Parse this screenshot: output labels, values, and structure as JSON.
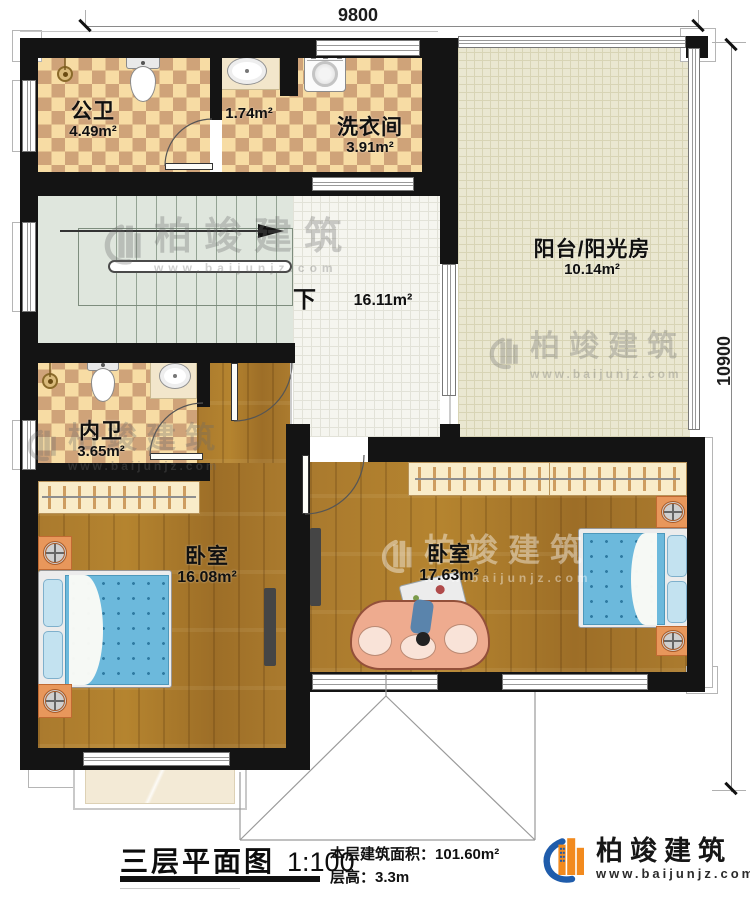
{
  "dims": {
    "top": "9800",
    "right": "10900"
  },
  "rooms": {
    "gongwei": {
      "name": "公卫",
      "area": "4.49m²"
    },
    "vestibule": {
      "area": "1.74m²"
    },
    "laundry": {
      "name": "洗衣间",
      "area": "3.91m²"
    },
    "sunroom": {
      "name": "阳台/阳光房",
      "area": "10.14m²"
    },
    "hall": {
      "stairs_label": "下",
      "area": "16.11m²"
    },
    "neiwei": {
      "name": "内卫",
      "area": "3.65m²"
    },
    "bedroom1": {
      "name": "卧室",
      "area": "16.08m²"
    },
    "bedroom2": {
      "name": "卧室",
      "area": "17.63m²"
    }
  },
  "footer": {
    "title": "三层平面图",
    "scale": "1:100",
    "area_label": "本层建筑面积：",
    "area_value": "101.60m²",
    "height_label": "层高：",
    "height_value": "3.3m"
  },
  "brand": {
    "name": "柏竣建筑",
    "url": "www.baijunjz.com"
  },
  "watermark": {
    "name": "柏竣建筑",
    "url": "www.baijunjz.com"
  },
  "colors": {
    "wall": "#141414",
    "checker_light": "#f7dca4",
    "checker_dark": "#cfa379",
    "wood": "#aa7a2e",
    "wood_dark": "#9d6e27",
    "tile_hall": "#f5f5ef",
    "sunroom": "#eae7d1",
    "stairs": "#dfe6dd",
    "wardrobe": "#f9ecc9",
    "bed_blue": "#6cb9dc",
    "sofa": "#eeab8f",
    "nightstand": "#e8975b",
    "brand_blue": "#1f5cab",
    "brand_orange": "#f28a1e"
  }
}
